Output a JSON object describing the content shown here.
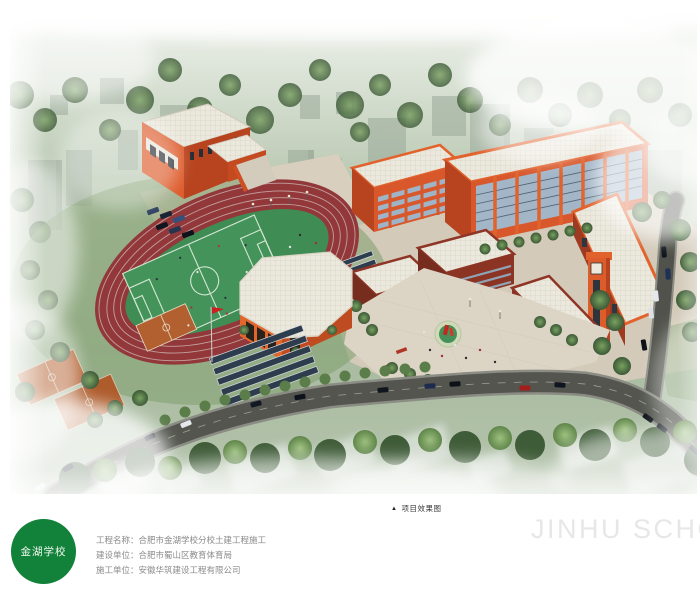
{
  "rendering": {
    "alt": "合肥市金湖学校分校 鸟瞰效果图（跑道、运动场、教学楼群、体育馆、道路）",
    "palette": {
      "building_orange": "#d8572b",
      "building_maroon": "#8c3423",
      "roof_white": "#ebe8dd",
      "track_red": "#93383a",
      "field_green": "#44935a",
      "court_orange": "#b2602f",
      "road_gray": "#53554e",
      "tree_green": "#4c6b40",
      "plaza_tan": "#d8cfbf",
      "mist_white": "#ffffff"
    }
  },
  "caption": {
    "marker": "▲",
    "text": "项目效果图"
  },
  "footer": {
    "logo_text": "金湖学校",
    "logo_color": "#12823a",
    "watermark": "JINHU SCHOOL",
    "info": [
      {
        "label": "工程名称：",
        "value": "合肥市金湖学校分校土建工程施工"
      },
      {
        "label": "建设单位：",
        "value": "合肥市蜀山区教育体育局"
      },
      {
        "label": "施工单位：",
        "value": "安徽华筑建设工程有限公司"
      }
    ]
  }
}
